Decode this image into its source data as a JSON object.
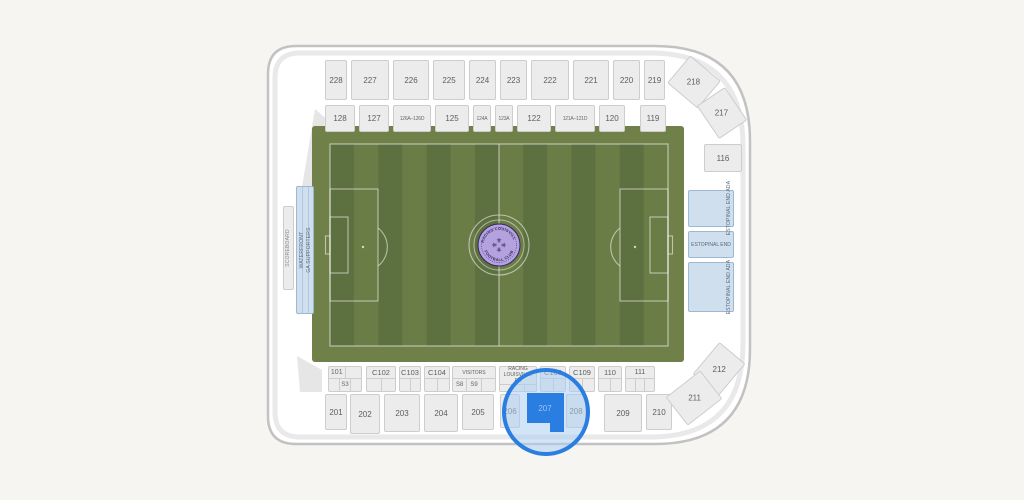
{
  "venue": {
    "colors": {
      "page_background": "#f7f5f2",
      "map_background": "#ffffff",
      "section_fill": "#ececec",
      "ga_blue_fill": "#cfdfee",
      "field_stripe_dark": "#5d7040",
      "field_stripe_light": "#6b7d47",
      "field_apron": "#6f8048",
      "highlight_blue": "#2a7de1",
      "highlight_halo": "#bdd7f1",
      "badge_fill": "#b4a2de",
      "badge_text": "#32265c"
    },
    "logo": {
      "arc_top": "RACING LOUISVILLE",
      "arc_bottom": "FOOTBALL CLUB",
      "emblem_glyph": "⚜"
    },
    "sections": {
      "north_upper": [
        "228",
        "227",
        "226",
        "225",
        "224",
        "223",
        "222",
        "221",
        "220",
        "219"
      ],
      "north_lower": [
        "128",
        "127",
        "126A–126D",
        "125",
        "124A",
        "123A",
        "122",
        "121A–121D",
        "120",
        "119"
      ],
      "corners": {
        "ne_top": "218",
        "ne_bottom": "217",
        "se_top": "212",
        "se_bottom": "211"
      },
      "east": {
        "s116": "116",
        "ada_top": "ESTOPINAL END ADA",
        "main": "ESTOPINAL END",
        "ada_bottom": "ESTOPINAL END ADA"
      },
      "west": {
        "scoreboard": "SCOREBOARD",
        "ga_line1": "WATERFRONT",
        "ga_line2": "GA SUPPORTERS"
      },
      "south_lower": {
        "s101": "101",
        "s3": "S3",
        "c102": "C102",
        "c103": "C103",
        "c104": "C104",
        "visitors": "VISITORS",
        "s8": "S8",
        "s9": "S9",
        "home_line1": "RACING",
        "home_line2": "LOUISVILLE FC",
        "c106": "C106",
        "c109": "C109",
        "s110": "110",
        "s111": "111"
      },
      "south_upper": [
        "201",
        "202",
        "203",
        "204",
        "205",
        "206",
        "208",
        "209",
        "210"
      ],
      "selected": "207"
    }
  }
}
